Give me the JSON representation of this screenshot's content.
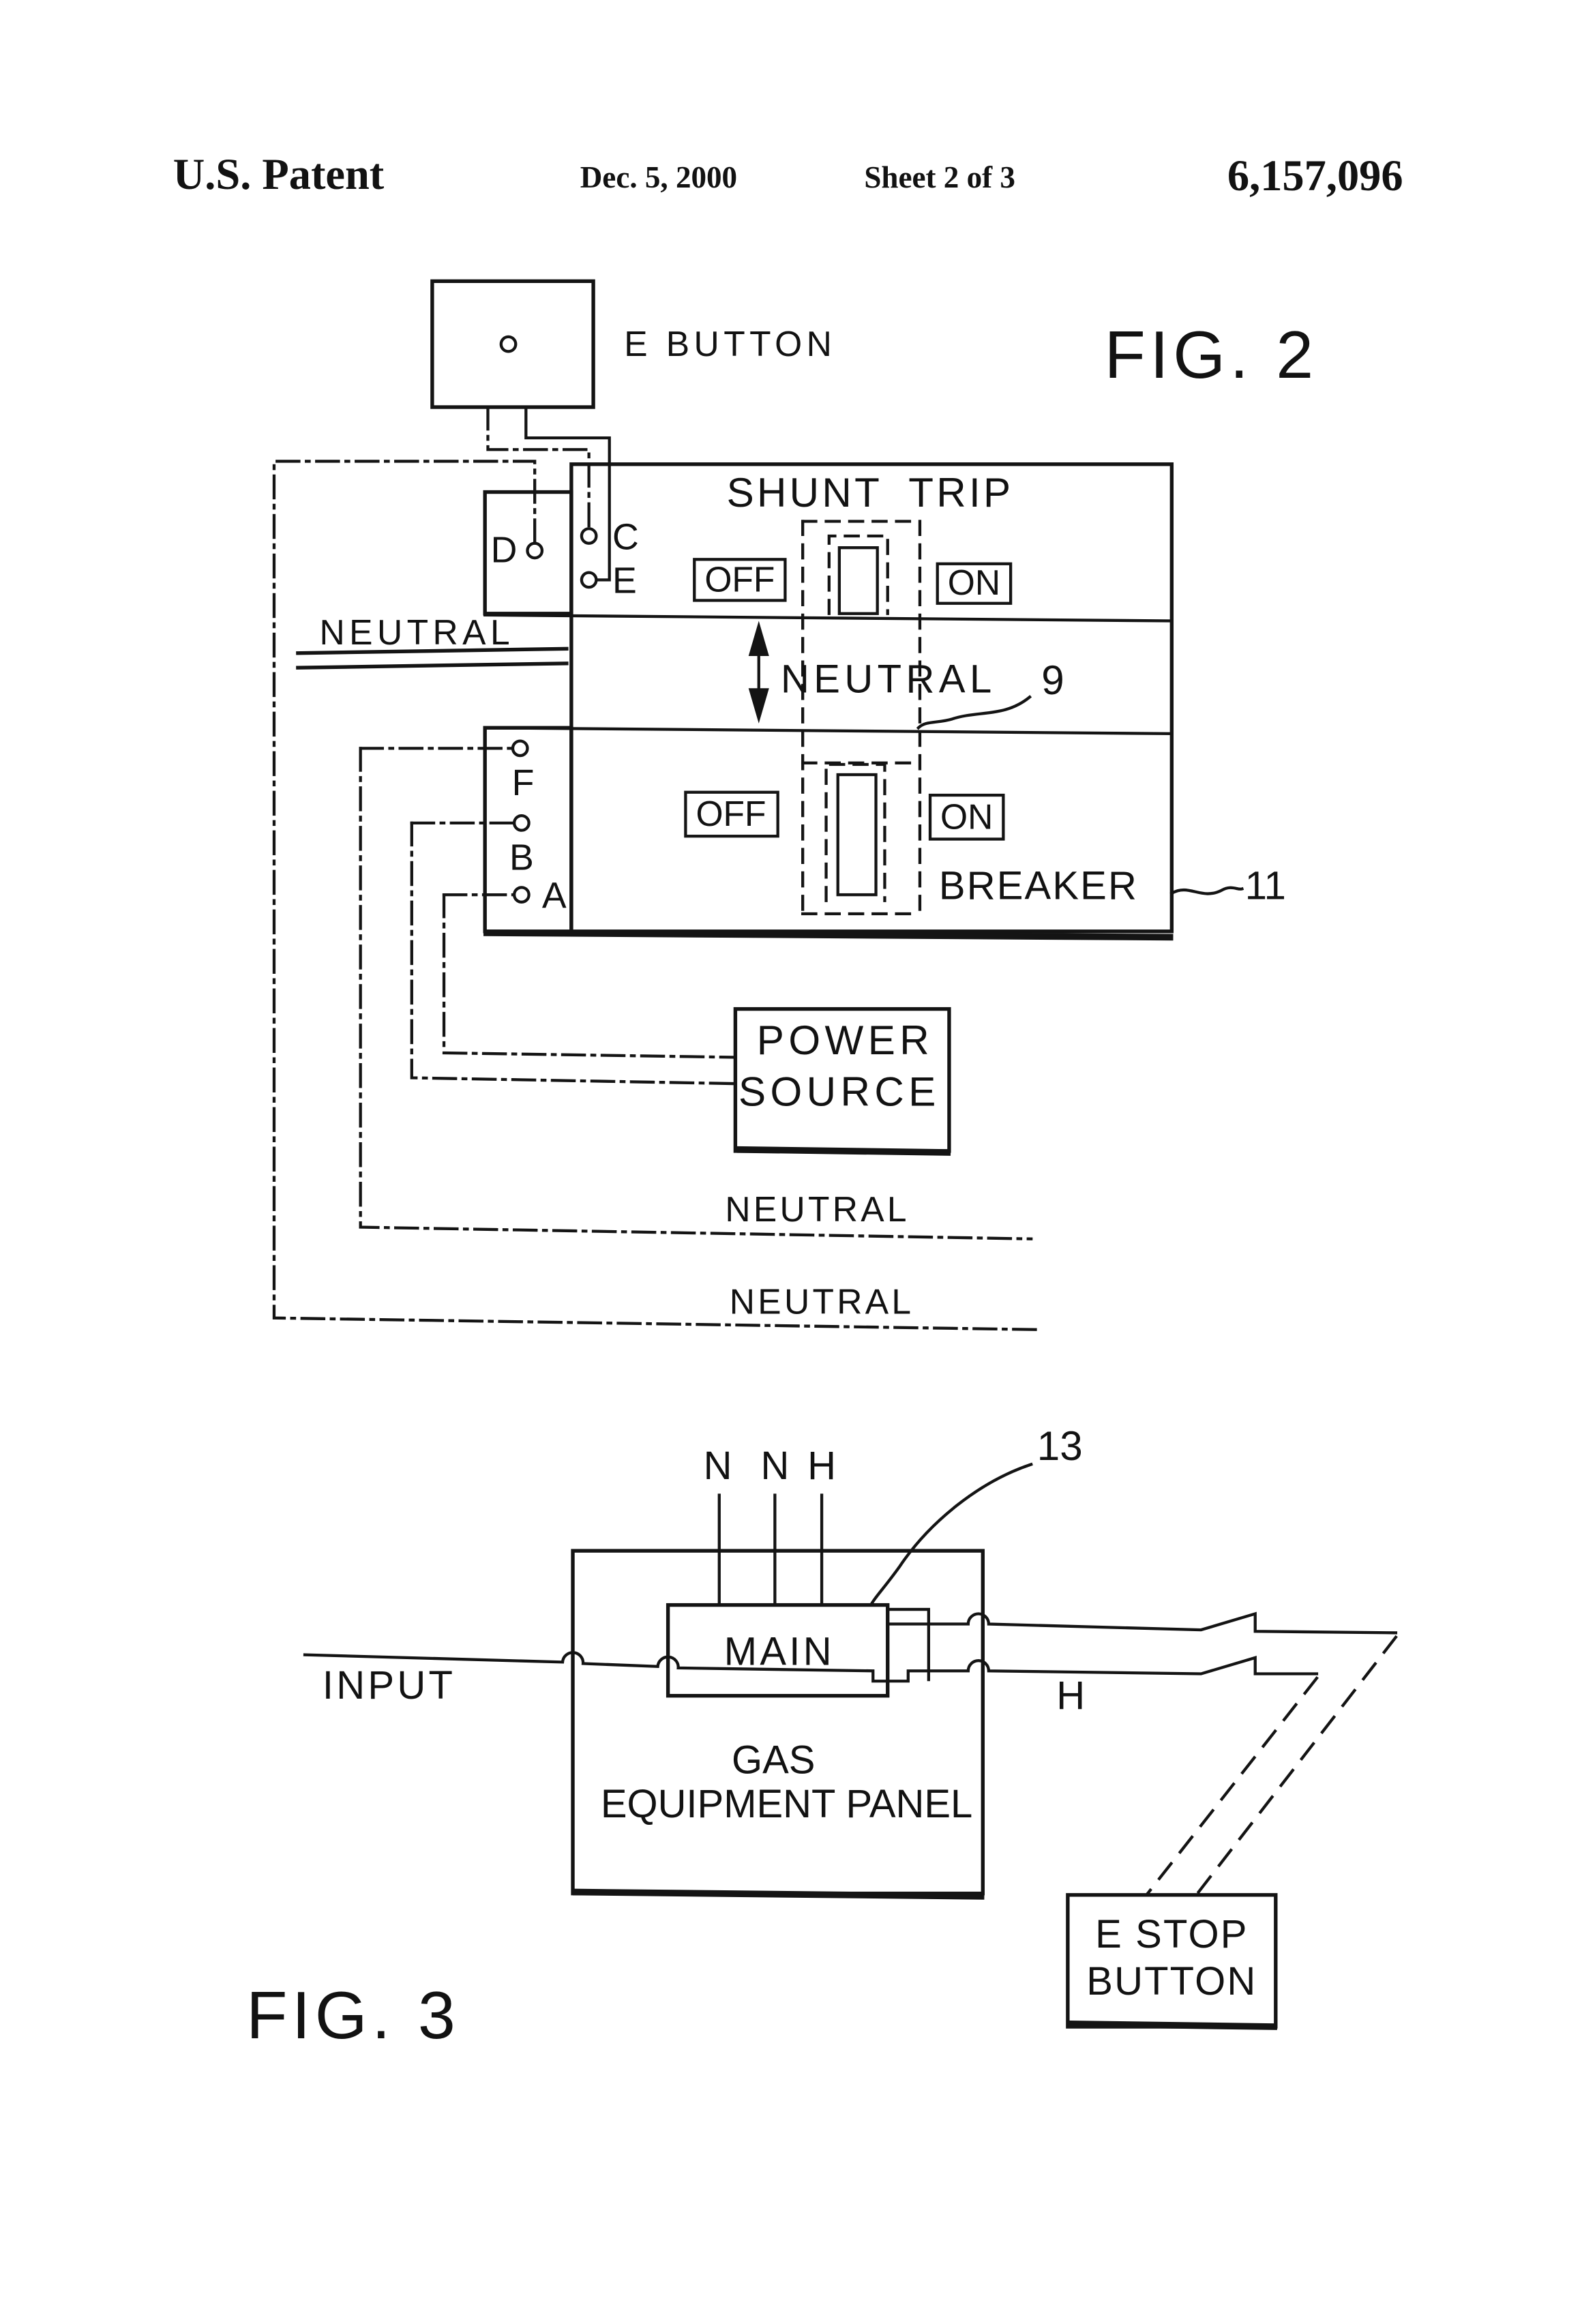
{
  "header": {
    "title": "U.S. Patent",
    "date": "Dec. 5, 2000",
    "sheet": "Sheet 2 of 3",
    "patent_number": "6,157,096"
  },
  "fig2": {
    "figure_label": "FIG. 2",
    "e_button_label": "E BUTTON",
    "shunt_trip_label": "SHUNT TRIP",
    "off_top": "OFF",
    "on_top": "ON",
    "off_bottom": "OFF",
    "on_bottom": "ON",
    "neutral_left": "NEUTRAL",
    "neutral_center": "NEUTRAL",
    "neutral_line1": "NEUTRAL",
    "neutral_line2": "NEUTRAL",
    "breaker_label": "BREAKER",
    "power_source_line1": "POWER",
    "power_source_line2": "SOURCE",
    "ref_9": "9",
    "ref_11": "11",
    "terminal_d": "D",
    "terminal_c": "C",
    "terminal_e": "E",
    "terminal_f": "F",
    "terminal_b": "B",
    "terminal_a": "A"
  },
  "fig3": {
    "figure_label": "FIG. 3",
    "ref_13": "13",
    "wire_n1": "N",
    "wire_n2": "N",
    "wire_h_top": "H",
    "wire_h_right": "H",
    "main_label": "MAIN",
    "input_label": "INPUT",
    "panel_line1": "GAS",
    "panel_line2": "EQUIPMENT PANEL",
    "e_stop_line1": "E STOP",
    "e_stop_line2": "BUTTON"
  }
}
